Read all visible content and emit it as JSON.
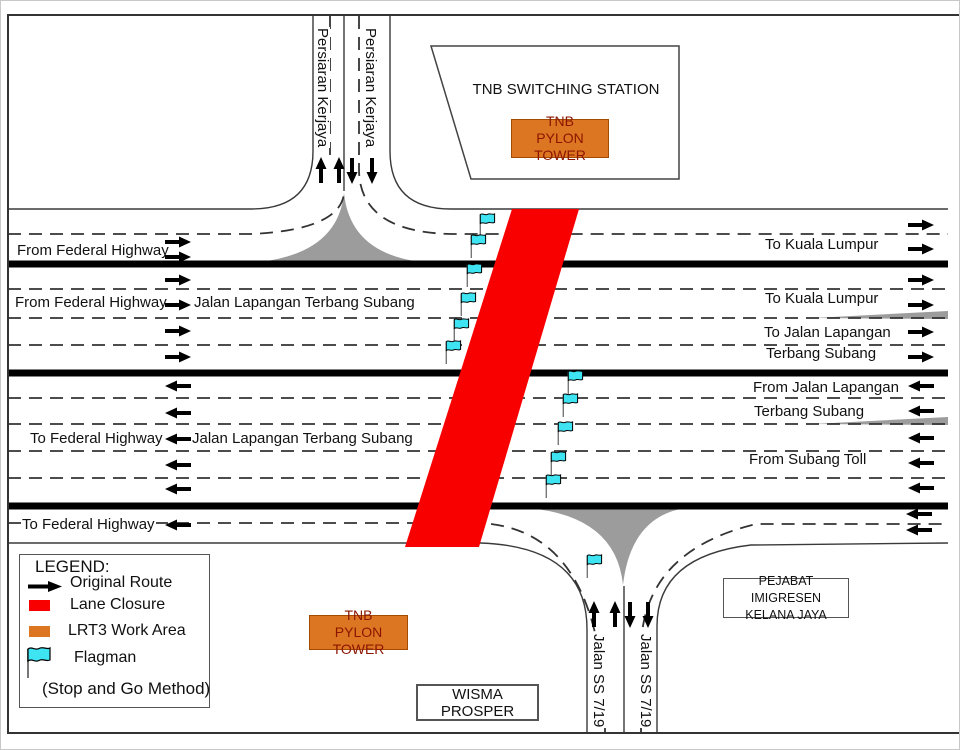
{
  "colors": {
    "lane_closure_red": "#f80000",
    "work_area_orange": "#dd7622",
    "pylon_text": "#8b1500",
    "flag_cyan": "#3fe4f2",
    "island_gray": "#9c9c9c",
    "line_black": "#000000"
  },
  "boxes": {
    "switching_station": "TNB SWITCHING STATION",
    "pylon_top": {
      "line1": "TNB",
      "line2": "PYLON TOWER"
    },
    "pylon_bottom": {
      "line1": "TNB",
      "line2": "PYLON TOWER"
    },
    "wisma": "WISMA PROSPER",
    "pejabat": {
      "line1": "PEJABAT IMIGRESEN",
      "line2": "KELANA JAYA"
    }
  },
  "legend": {
    "title": "LEGEND:",
    "items": [
      {
        "icon": "arrow",
        "label": "Original Route"
      },
      {
        "icon": "red-swatch",
        "label": "Lane Closure"
      },
      {
        "icon": "orange-swatch",
        "label": "LRT3 Work Area"
      },
      {
        "icon": "flag",
        "label": "Flagman"
      }
    ],
    "note": "(Stop and Go Method)"
  },
  "road_labels": [
    {
      "id": "from-federal-highway-top",
      "text": "From Federal Highway",
      "x": 15,
      "y": 242
    },
    {
      "id": "from-federal-highway-2",
      "text": "From Federal Highway",
      "x": 13,
      "y": 294
    },
    {
      "id": "jalan-lapangan-eastbound",
      "text": "Jalan Lapangan Terbang Subang",
      "x": 192,
      "y": 294
    },
    {
      "id": "to-kuala-lumpur-1",
      "text": "To Kuala Lumpur",
      "x": 763,
      "y": 236
    },
    {
      "id": "to-kuala-lumpur-2",
      "text": "To Kuala Lumpur",
      "x": 763,
      "y": 290
    },
    {
      "id": "to-jalan-lapangan",
      "text": "To Jalan Lapangan",
      "x": 762,
      "y": 324
    },
    {
      "id": "terbang-subang-east",
      "text": "Terbang Subang",
      "x": 764,
      "y": 345
    },
    {
      "id": "from-jalan-lapangan",
      "text": "From Jalan Lapangan",
      "x": 751,
      "y": 379
    },
    {
      "id": "terbang-subang-west",
      "text": "Terbang Subang",
      "x": 752,
      "y": 403
    },
    {
      "id": "to-federal-highway-1",
      "text": "To Federal Highway",
      "x": 28,
      "y": 430
    },
    {
      "id": "jalan-lapangan-westbound",
      "text": "Jalan Lapangan Terbang Subang",
      "x": 190,
      "y": 430
    },
    {
      "id": "from-subang-toll",
      "text": "From Subang Toll",
      "x": 747,
      "y": 451
    },
    {
      "id": "to-federal-highway-2",
      "text": "To Federal Highway",
      "x": 20,
      "y": 516
    },
    {
      "id": "persiaran-kerjaya-1",
      "text": "Persiaran Kerjaya",
      "x": 313,
      "y": 26,
      "vertical": true
    },
    {
      "id": "persiaran-kerjaya-2",
      "text": "Persiaran Kerjaya",
      "x": 361,
      "y": 26,
      "vertical": true
    },
    {
      "id": "jalan-ss-719-1",
      "text": "Jalan SS 7/19",
      "x": 589,
      "y": 632,
      "vertical": true
    },
    {
      "id": "jalan-ss-719-2",
      "text": "Jalan SS 7/19",
      "x": 636,
      "y": 632,
      "vertical": true
    }
  ],
  "route_arrows": [
    {
      "x": 177,
      "y": 241,
      "dir": "E"
    },
    {
      "x": 177,
      "y": 256,
      "dir": "E"
    },
    {
      "x": 177,
      "y": 279,
      "dir": "E"
    },
    {
      "x": 177,
      "y": 304,
      "dir": "E"
    },
    {
      "x": 177,
      "y": 330,
      "dir": "E"
    },
    {
      "x": 177,
      "y": 356,
      "dir": "E"
    },
    {
      "x": 920,
      "y": 224,
      "dir": "E"
    },
    {
      "x": 920,
      "y": 248,
      "dir": "E"
    },
    {
      "x": 920,
      "y": 279,
      "dir": "E"
    },
    {
      "x": 920,
      "y": 304,
      "dir": "E"
    },
    {
      "x": 920,
      "y": 331,
      "dir": "E"
    },
    {
      "x": 920,
      "y": 356,
      "dir": "E"
    },
    {
      "x": 177,
      "y": 385,
      "dir": "W"
    },
    {
      "x": 177,
      "y": 412,
      "dir": "W"
    },
    {
      "x": 177,
      "y": 438,
      "dir": "W"
    },
    {
      "x": 177,
      "y": 464,
      "dir": "W"
    },
    {
      "x": 177,
      "y": 488,
      "dir": "W"
    },
    {
      "x": 177,
      "y": 524,
      "dir": "W"
    },
    {
      "x": 920,
      "y": 385,
      "dir": "W"
    },
    {
      "x": 920,
      "y": 410,
      "dir": "W"
    },
    {
      "x": 920,
      "y": 437,
      "dir": "W"
    },
    {
      "x": 920,
      "y": 462,
      "dir": "W"
    },
    {
      "x": 920,
      "y": 487,
      "dir": "W"
    },
    {
      "x": 918,
      "y": 513,
      "dir": "W"
    },
    {
      "x": 918,
      "y": 529,
      "dir": "W"
    },
    {
      "x": 320,
      "y": 169,
      "dir": "N"
    },
    {
      "x": 338,
      "y": 169,
      "dir": "N"
    },
    {
      "x": 351,
      "y": 170,
      "dir": "S"
    },
    {
      "x": 371,
      "y": 170,
      "dir": "S"
    },
    {
      "x": 593,
      "y": 613,
      "dir": "N"
    },
    {
      "x": 614,
      "y": 613,
      "dir": "N"
    },
    {
      "x": 629,
      "y": 614,
      "dir": "S"
    },
    {
      "x": 647,
      "y": 614,
      "dir": "S"
    }
  ],
  "flagmen": [
    {
      "x": 478,
      "y": 211
    },
    {
      "x": 469,
      "y": 232
    },
    {
      "x": 465,
      "y": 261
    },
    {
      "x": 459,
      "y": 290
    },
    {
      "x": 452,
      "y": 316
    },
    {
      "x": 444,
      "y": 338
    },
    {
      "x": 566,
      "y": 368
    },
    {
      "x": 561,
      "y": 391
    },
    {
      "x": 556,
      "y": 419
    },
    {
      "x": 549,
      "y": 449
    },
    {
      "x": 544,
      "y": 472
    },
    {
      "x": 585,
      "y": 552
    }
  ]
}
